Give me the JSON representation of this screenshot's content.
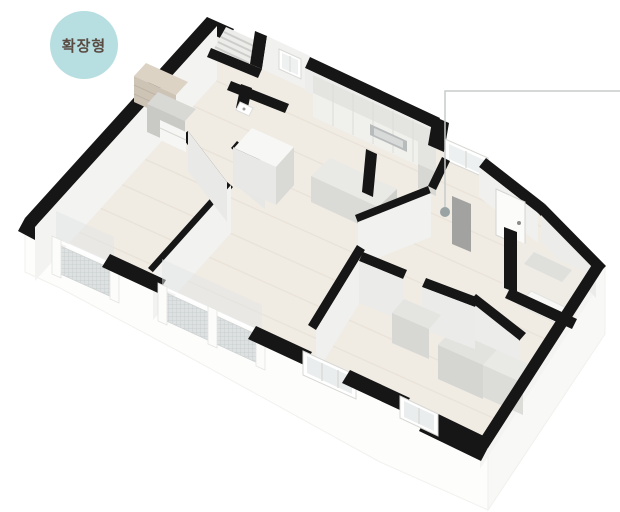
{
  "page": {
    "background_color": "#ffffff"
  },
  "badge": {
    "label": "확장형",
    "background_color": "#b7dee1",
    "text_color": "#594a42"
  },
  "floorplan": {
    "kind": "isometric-3d-apartment-floorplan",
    "wall_top_color": "#161616",
    "wall_face_color": "#f0f0ee",
    "floor_color": "#f0ebe3",
    "cabinet_color": "#d8d8d5",
    "railing_mesh_color": "#ccd0d0",
    "callout": {
      "line_color": "#c8cccc",
      "marker_color": "#9aa3a3"
    }
  }
}
